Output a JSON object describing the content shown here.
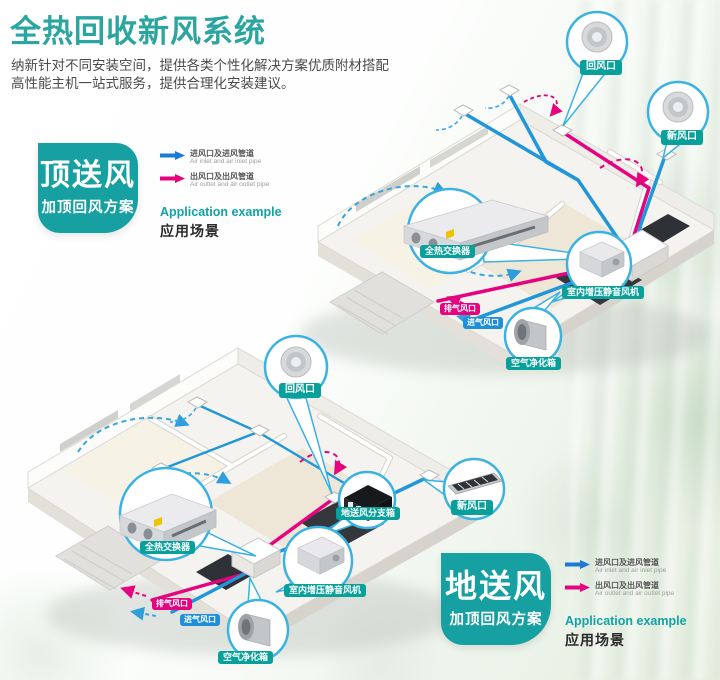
{
  "header": {
    "title": "全热回收新风系统",
    "subtitle_line1": "纳新针对不同安装空间，提供各类个性化解决方案优质附材搭配",
    "subtitle_line2": "高性能主机一站式服务，提供合理化安装建议。"
  },
  "colors": {
    "teal": "#17a0a1",
    "duct_blue": "#2196d8",
    "arrow_blue": "#1d7ad4",
    "magenta": "#e4047f"
  },
  "legend": {
    "inlet_cn": "进风口及进风管道",
    "inlet_en": "Air inlet and air inlet pipe",
    "outlet_cn": "出风口及出风管道",
    "outlet_en": "Air outlet and air outlet pipe",
    "application_en": "Application example",
    "application_cn": "应用场景"
  },
  "scheme_top": {
    "badge_title": "顶送风",
    "badge_subtitle": "加顶回风方案"
  },
  "scheme_bottom": {
    "badge_title": "地送风",
    "badge_subtitle": "加顶回风方案"
  },
  "diagram_top": {
    "labels": {
      "return_air_vent": "回风口",
      "fresh_air_vent": "新风口",
      "heat_exchanger": "全热交换器",
      "booster_fan": "室内增压静音风机",
      "exhaust_vent": "排气风口",
      "intake_vent": "进气风口",
      "air_purifier": "空气净化箱"
    }
  },
  "diagram_bottom": {
    "labels": {
      "return_air_vent": "回风口",
      "fresh_air_vent": "新风口",
      "heat_exchanger": "全热交换器",
      "booster_fan": "室内增压静音风机",
      "exhaust_vent": "排气风口",
      "intake_vent": "进气风口",
      "air_purifier": "空气净化箱",
      "floor_supply_branch_box": "地送风分支箱"
    }
  }
}
